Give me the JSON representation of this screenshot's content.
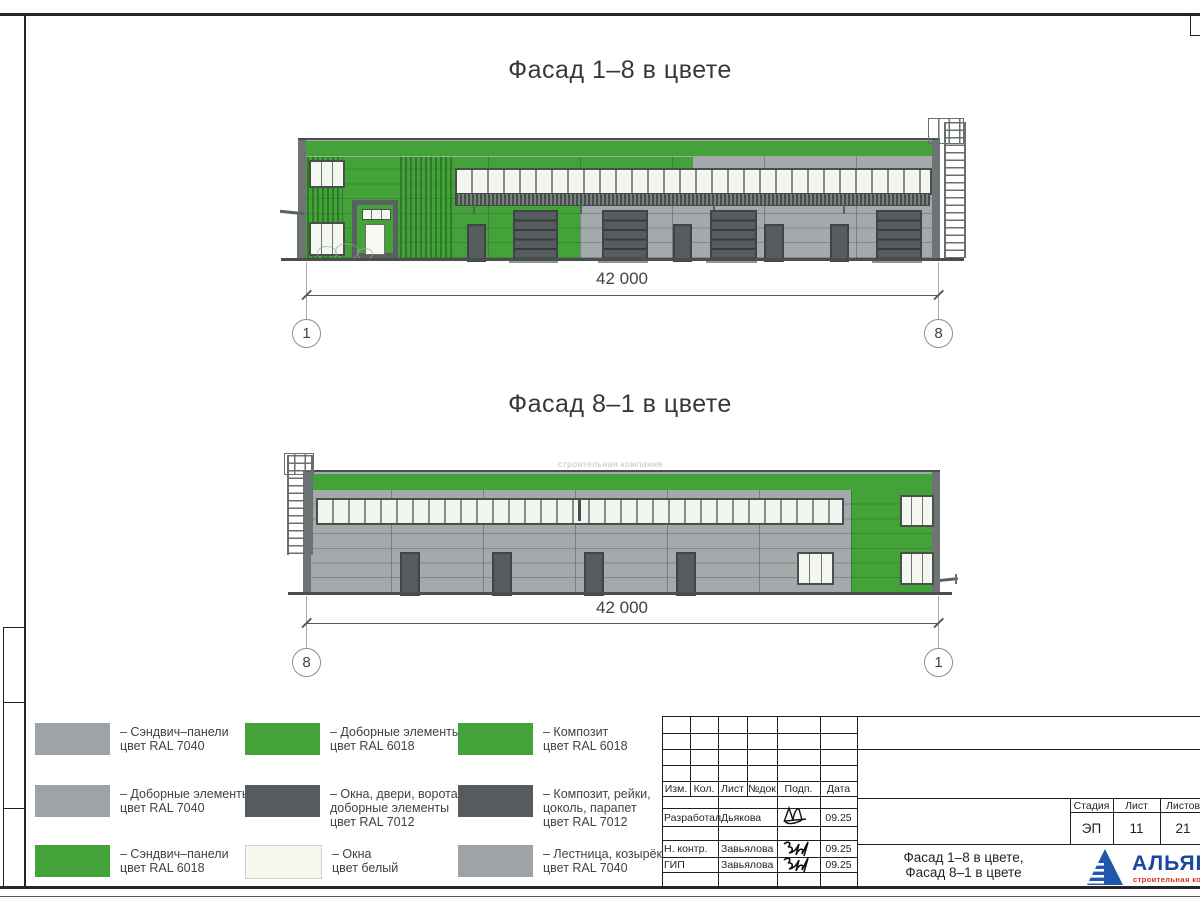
{
  "drawing": {
    "facade1": {
      "title": "Фасад 1–8 в цвете",
      "dimension": "42 000",
      "axis_left": "1",
      "axis_right": "8"
    },
    "facade2": {
      "title": "Фасад 8–1 в цвете",
      "dimension": "42 000",
      "axis_left": "8",
      "axis_right": "1",
      "watermark": "строительная компания"
    }
  },
  "legend": {
    "items": [
      {
        "color": "#9ea3a8",
        "lines": [
          "– Сэндвич–панели",
          "цвет RAL 7040"
        ]
      },
      {
        "color": "#9ea3a8",
        "lines": [
          "– Доборные элементы",
          "цвет RAL 7040"
        ]
      },
      {
        "color": "#44a338",
        "lines": [
          "– Сэндвич–панели",
          "цвет RAL 6018"
        ]
      },
      {
        "color": "#44a338",
        "lines": [
          "– Доборные элементы",
          "цвет RAL 6018"
        ]
      },
      {
        "color": "#565c5e",
        "lines": [
          "– Окна, двери, ворота,",
          "доборные элементы",
          "цвет RAL 7012"
        ]
      },
      {
        "color": "#f5f7ec",
        "lines": [
          "– Окна",
          "цвет белый"
        ]
      },
      {
        "color": "#44a338",
        "lines": [
          "– Композит",
          "цвет RAL 6018"
        ]
      },
      {
        "color": "#565c5e",
        "lines": [
          "– Композит, рейки,",
          "цоколь, парапет",
          "цвет RAL 7012"
        ]
      },
      {
        "color": "#9ea3a8",
        "lines": [
          "– Лестница, козырёк",
          "цвет RAL 7040"
        ]
      }
    ]
  },
  "titleblock": {
    "cols": {
      "izm": "Изм.",
      "kol": "Кол.",
      "list": "Лист",
      "ndok": "№док",
      "podp": "Подп.",
      "data": "Дата"
    },
    "rows": [
      {
        "role": "Разработал",
        "name": "Дьякова",
        "date": "09.25"
      },
      {
        "role": "Н. контр.",
        "name": "Завьялова",
        "date": "09.25"
      },
      {
        "role": "ГИП",
        "name": "Завьялова",
        "date": "09.25"
      }
    ],
    "stage_label": "Стадия",
    "sheet_label": "Лист",
    "sheets_label": "Листов",
    "stage": "ЭП",
    "sheet": "11",
    "sheets": "21",
    "doc_title1": "Фасад 1–8 в цвете,",
    "doc_title2": "Фасад 8–1 в цвете",
    "company": "АЛЬЯНС",
    "company_sub": "строительная компания"
  },
  "colors": {
    "green_ral6018": "#44a338",
    "gray_ral7040": "#9ea3a8",
    "dark_ral7012": "#565c5e",
    "window_white": "#f5f7ec",
    "logo_blue": "#1e57ab",
    "logo_red": "#d3301c"
  }
}
